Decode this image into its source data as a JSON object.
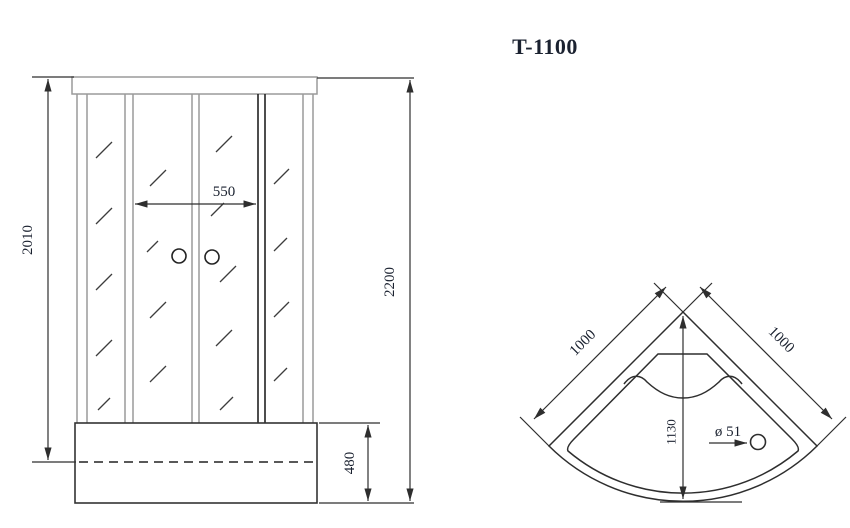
{
  "title": "T-1100",
  "front_view": {
    "dimensions": {
      "cabin_height": "2010",
      "door_opening_width": "550",
      "total_height": "2200",
      "tray_height": "480"
    }
  },
  "top_view": {
    "dimensions": {
      "side_left": "1000",
      "side_right": "1000",
      "depth": "1130",
      "drain_diameter": "ø 51"
    }
  },
  "colors": {
    "line": "#2e2e2e",
    "frame_line": "#9a9a9a",
    "glass_hatch": "#3d3d3d",
    "text": "#1b2230",
    "background": "#ffffff"
  }
}
